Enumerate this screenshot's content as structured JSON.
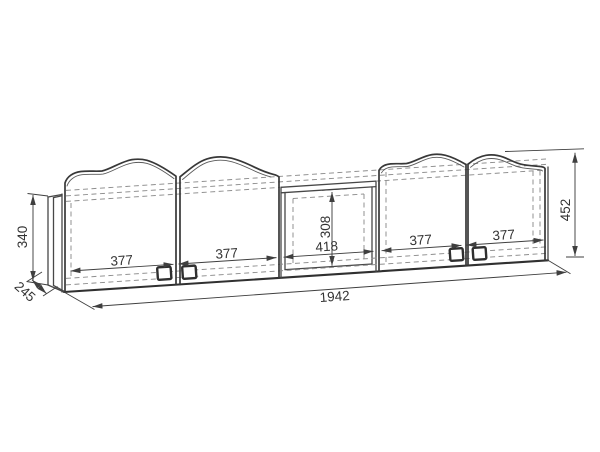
{
  "drawing": {
    "type": "furniture technical dimension drawing (wall shelf unit with four arched doors and open niche)",
    "colors": {
      "background": "#ffffff",
      "outline": "#383838",
      "hidden_lines": "#8d8d8d",
      "dimension_lines": "#3f3f3f",
      "label_text": "#333333"
    },
    "labels": {
      "carcass_height": "340",
      "depth": "245",
      "door1_width": "377",
      "door2_width": "377",
      "niche_width": "418",
      "niche_height": "308",
      "door3_width": "377",
      "door4_width": "377",
      "overall_height": "452",
      "overall_width": "1942"
    }
  }
}
